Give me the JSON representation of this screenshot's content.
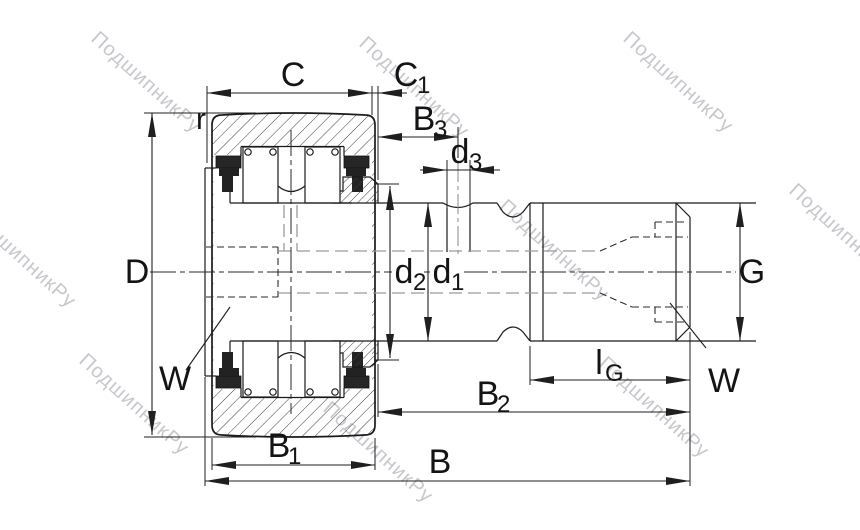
{
  "watermark": {
    "text": "ПодшипникРу",
    "color": "#c7c7cd"
  },
  "drawing": {
    "line_color": "#1a1a1a",
    "label_color": "#141414",
    "dimensions": {
      "C": {
        "label": "C"
      },
      "C1": {
        "base": "C",
        "sub": "1"
      },
      "B3": {
        "base": "B",
        "sub": "3"
      },
      "d3": {
        "base": "d",
        "sub": "3"
      },
      "r": {
        "label": "r"
      },
      "D": {
        "label": "D"
      },
      "d2": {
        "base": "d",
        "sub": "2"
      },
      "d1": {
        "base": "d",
        "sub": "1"
      },
      "G": {
        "label": "G"
      },
      "lG": {
        "base": "l",
        "sub": "G"
      },
      "W": {
        "label": "W"
      },
      "B2": {
        "base": "B",
        "sub": "2"
      },
      "B1": {
        "base": "B",
        "sub": "1"
      },
      "B": {
        "label": "B"
      }
    }
  }
}
